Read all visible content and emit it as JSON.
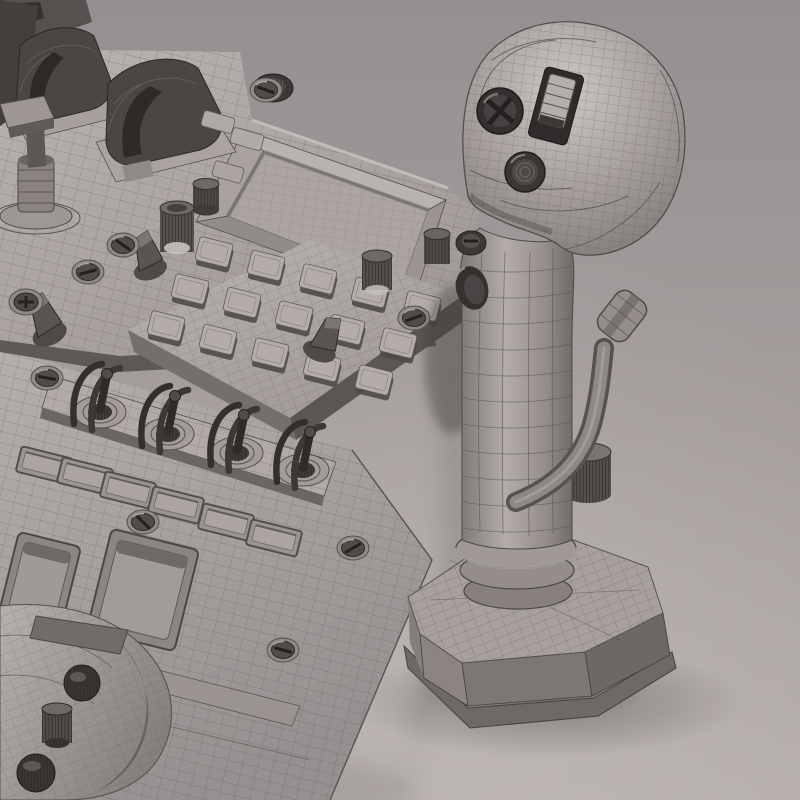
{
  "scene": {
    "title": "Untextured wireframe 3D render of a cockpit control console with a flight joystick",
    "style": "gray clay render with polygon wireframe overlay on a seamless studio backdrop",
    "background": {
      "top": "#949091",
      "middle": "#a49d9c",
      "bottom": "#b6afac"
    },
    "colors": {
      "wireframe": "#55504e",
      "plate_light": "#b9b3b0",
      "plate_mid": "#a8a19e",
      "plate_dark": "#8a8482",
      "side_dark": "#5e5957",
      "control_dark": "#3a3634",
      "recess": "#4b4745",
      "highlight": "#cdc7c4",
      "shadow": "rgba(59,54,52,0.35)"
    },
    "objects": {
      "console": {
        "label": "control console panels",
        "modules": [
          "guarded switch covers",
          "trim stick with square cap",
          "recessed display bezel",
          "keypad button grid",
          "knurled rotary knobs",
          "pointer knobs",
          "toggle switches with wire guards",
          "indicator windows",
          "recessed slots",
          "slotted panel screws",
          "curved housing with dome buttons"
        ]
      },
      "joystick": {
        "label": "flight joystick",
        "parts": [
          "grip head",
          "slotted hat button",
          "rectangular thumb switch",
          "round ribbed thumb button",
          "curved shaft",
          "side trigger lever",
          "rubber bellows rings",
          "pedestal base"
        ]
      }
    },
    "counts": {
      "keypad_keys": 15,
      "toggle_switches": 4,
      "indicator_windows": 6,
      "visible_screws": 9
    }
  }
}
